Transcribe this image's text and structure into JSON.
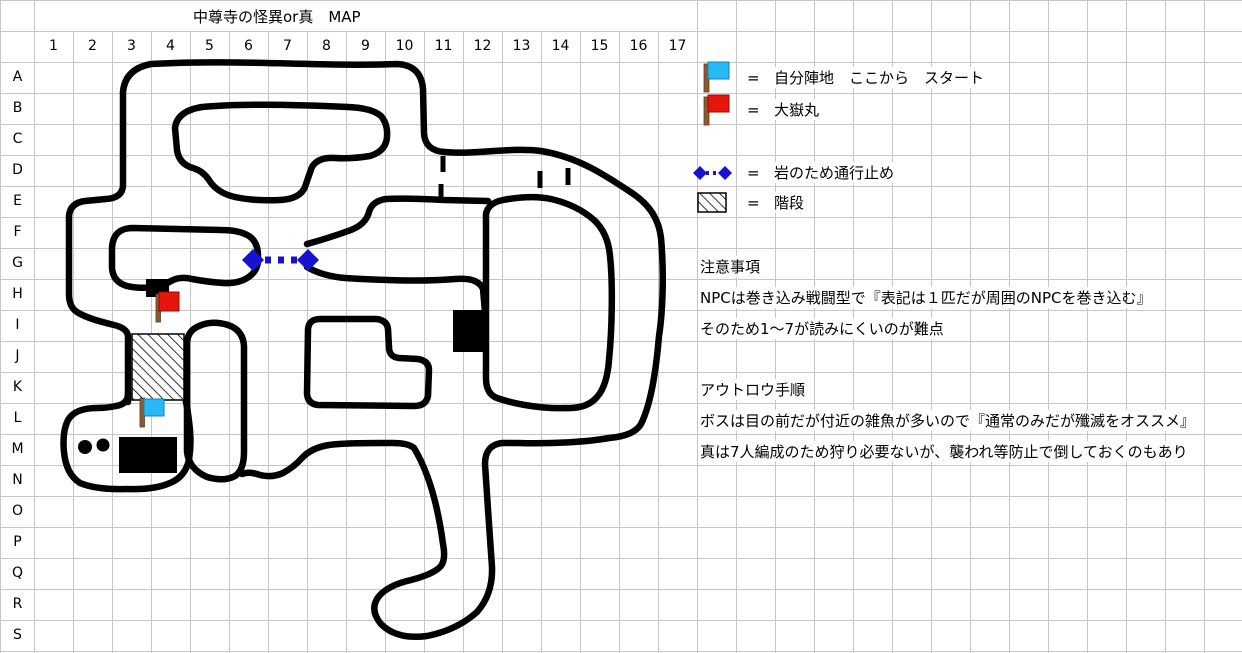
{
  "title": "中尊寺の怪異or真　MAP",
  "grid": {
    "columns": [
      "1",
      "2",
      "3",
      "4",
      "5",
      "6",
      "7",
      "8",
      "9",
      "10",
      "11",
      "12",
      "13",
      "14",
      "15",
      "16",
      "17"
    ],
    "rows": [
      "A",
      "B",
      "C",
      "D",
      "E",
      "F",
      "G",
      "H",
      "I",
      "J",
      "K",
      "L",
      "M",
      "N",
      "O",
      "P",
      "Q",
      "R",
      "S"
    ]
  },
  "legend": {
    "items": [
      {
        "icon": "cyan-flag-icon",
        "equals": "=",
        "label": "自分陣地　ここから　スタート"
      },
      {
        "icon": "red-flag-icon",
        "equals": "=",
        "label": "大嶽丸"
      },
      {
        "icon": "rock-barrier-icon",
        "equals": "=",
        "label": "岩のため通行止め"
      },
      {
        "icon": "stairs-icon",
        "equals": "=",
        "label": "階段"
      }
    ]
  },
  "notes": {
    "caution_heading": "注意事項",
    "caution_line1": "NPCは巻き込み戦闘型で『表記は１匹だが周囲のNPCを巻き込む』",
    "caution_line2": "そのため1～7が読みにくいのが難点",
    "outlaw_heading": "アウトロウ手順",
    "outlaw_line1": "ボスは目の前だが付近の雑魚が多いので『通常のみだが殲滅をオススメ』",
    "outlaw_line2": "真は7人編成のため狩り必要ないが、襲われ等防止で倒しておくのもあり"
  },
  "colors": {
    "background": "#ffffff",
    "grid": "#c6c6c6",
    "wall": "#000000",
    "text": "#000000",
    "flag_cyan": "#29b9f2",
    "flag_red": "#e8150d",
    "pole_brown": "#8b5a33",
    "rock_blue": "#1612d0"
  }
}
